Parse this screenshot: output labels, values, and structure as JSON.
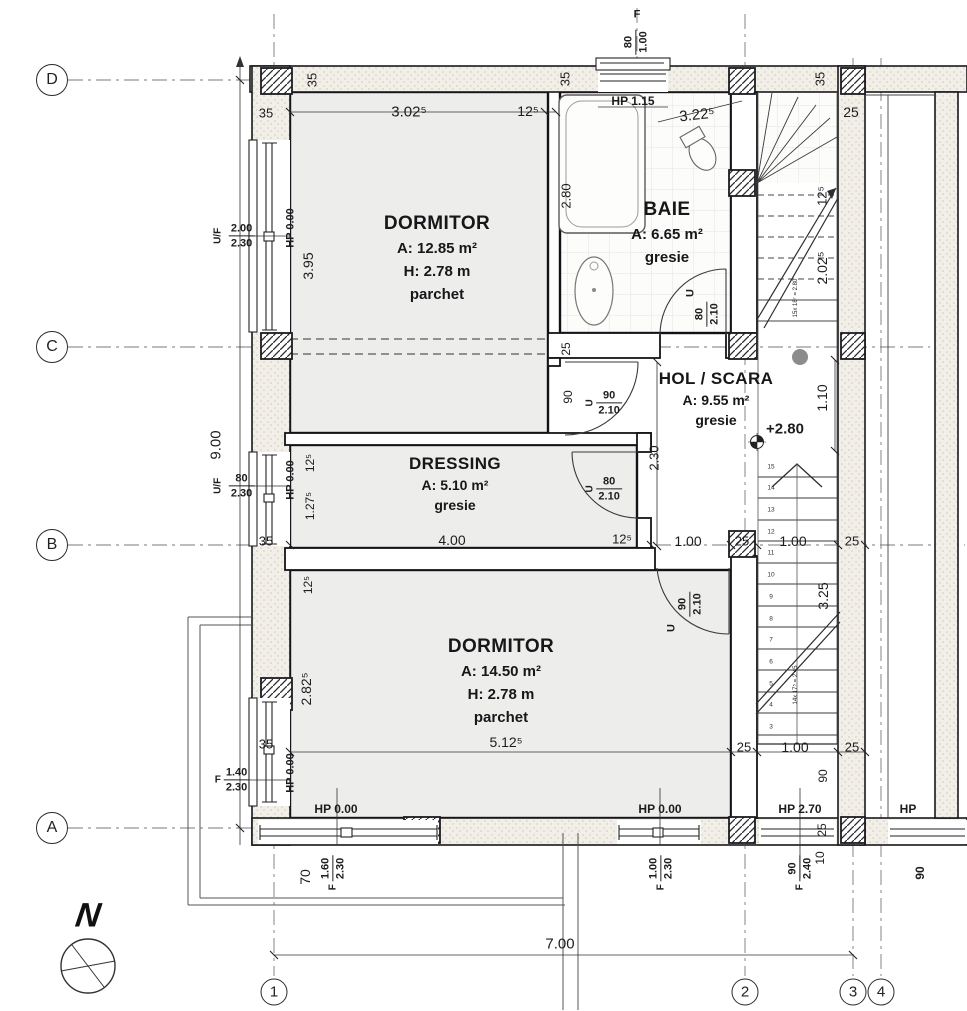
{
  "plan": {
    "type": "architectural-floor-plan",
    "north_label": "N",
    "overall": {
      "width": "7.00",
      "height": "9.00"
    },
    "grid": {
      "rows": [
        {
          "label": "D",
          "y": 80
        },
        {
          "label": "C",
          "y": 347
        },
        {
          "label": "B",
          "y": 545
        },
        {
          "label": "A",
          "y": 828
        }
      ],
      "cols": [
        {
          "label": "1",
          "x": 274
        },
        {
          "label": "2",
          "x": 745
        },
        {
          "label": "3",
          "x": 853
        },
        {
          "label": "4",
          "x": 881
        }
      ]
    },
    "rooms": [
      {
        "name": "DORMITOR",
        "area": "A: 12.85 m²",
        "height": "H: 2.78 m",
        "floor": "parchet",
        "x": 437,
        "y": 214
      },
      {
        "name": "BAIE",
        "area": "A: 6.65 m²",
        "floor": "gresie",
        "x": 667,
        "y": 200
      },
      {
        "name": "HOL / SCARA",
        "area": "A: 9.55 m²",
        "floor": "gresie",
        "x": 716,
        "y": 370,
        "small": 1
      },
      {
        "name": "DRESSING",
        "area": "A: 5.10 m²",
        "floor": "gresie",
        "x": 455,
        "y": 455,
        "small": 1
      },
      {
        "name": "DORMITOR",
        "area": "A: 14.50 m²",
        "height": "H: 2.78 m",
        "floor": "parchet",
        "x": 501,
        "y": 637
      }
    ],
    "dim_labels": [
      {
        "t": "F",
        "x": 637,
        "y": 15,
        "s": 11,
        "b": 1
      },
      {
        "t": "HP 1.15",
        "x": 633,
        "y": 101,
        "s": 12,
        "b": 1
      },
      {
        "t": "3.02⁵",
        "x": 409,
        "y": 112,
        "s": 15
      },
      {
        "t": "12⁵",
        "x": 528,
        "y": 111,
        "s": 14
      },
      {
        "t": "3.22⁵",
        "x": 697,
        "y": 115,
        "s": 15,
        "r": -6
      },
      {
        "t": "35",
        "x": 312,
        "y": 80,
        "s": 13,
        "r": -90
      },
      {
        "t": "35",
        "x": 565,
        "y": 79,
        "s": 13,
        "r": -90
      },
      {
        "t": "35",
        "x": 820,
        "y": 79,
        "s": 13,
        "r": -90
      },
      {
        "t": "35",
        "x": 266,
        "y": 113,
        "s": 13
      },
      {
        "t": "25",
        "x": 851,
        "y": 112,
        "s": 14
      },
      {
        "t": "HP 0.00",
        "x": 291,
        "y": 228,
        "s": 11,
        "b": 1,
        "r": -90
      },
      {
        "t": "3.95",
        "x": 308,
        "y": 266,
        "s": 14,
        "r": -90
      },
      {
        "t": "2.80",
        "x": 566,
        "y": 196,
        "s": 13,
        "r": -90
      },
      {
        "t": "9.00",
        "x": 216,
        "y": 445,
        "s": 15,
        "r": -90
      },
      {
        "t": "25",
        "x": 566,
        "y": 349,
        "s": 12,
        "r": -90
      },
      {
        "t": "90",
        "x": 568,
        "y": 397,
        "s": 12,
        "r": -90
      },
      {
        "t": "2.30",
        "x": 654,
        "y": 458,
        "s": 13,
        "r": -90
      },
      {
        "t": "1.10",
        "x": 822,
        "y": 398,
        "s": 14,
        "r": -90
      },
      {
        "t": "12⁵",
        "x": 822,
        "y": 196,
        "s": 13,
        "r": -90
      },
      {
        "t": "2.02⁵",
        "x": 822,
        "y": 268,
        "s": 14,
        "r": -90
      },
      {
        "t": "15x 18⁷ = 2.80",
        "x": 796,
        "y": 298,
        "s": 6,
        "r": -90
      },
      {
        "t": "+2.80",
        "x": 785,
        "y": 429,
        "s": 15,
        "b": 1
      },
      {
        "t": "U",
        "x": 691,
        "y": 293,
        "s": 11,
        "b": 1,
        "r": -90
      },
      {
        "t": "U",
        "x": 672,
        "y": 628,
        "s": 11,
        "b": 1,
        "r": -90
      },
      {
        "t": "HP 0.00",
        "x": 291,
        "y": 480,
        "s": 11,
        "b": 1,
        "r": -90
      },
      {
        "t": "12⁵",
        "x": 310,
        "y": 463,
        "s": 12,
        "r": -90
      },
      {
        "t": "1.27⁵",
        "x": 310,
        "y": 506,
        "s": 12,
        "r": -90
      },
      {
        "t": "35",
        "x": 266,
        "y": 541,
        "s": 13
      },
      {
        "t": "4.00",
        "x": 452,
        "y": 540,
        "s": 14
      },
      {
        "t": "12⁵",
        "x": 622,
        "y": 539,
        "s": 13
      },
      {
        "t": "1.00",
        "x": 688,
        "y": 541,
        "s": 14
      },
      {
        "t": "25",
        "x": 742,
        "y": 541,
        "s": 13
      },
      {
        "t": "1.00",
        "x": 793,
        "y": 541,
        "s": 14
      },
      {
        "t": "25",
        "x": 852,
        "y": 541,
        "s": 13
      },
      {
        "t": "12⁵",
        "x": 308,
        "y": 585,
        "s": 12,
        "r": -90
      },
      {
        "t": "2.82⁵",
        "x": 306,
        "y": 689,
        "s": 14,
        "r": -90
      },
      {
        "t": "3.25",
        "x": 823,
        "y": 596,
        "s": 14,
        "r": -90
      },
      {
        "t": "14x 17⁵ = 2.45",
        "x": 796,
        "y": 685,
        "s": 6,
        "r": -90
      },
      {
        "t": "HP 0.00",
        "x": 291,
        "y": 773,
        "s": 11,
        "b": 1,
        "r": -90
      },
      {
        "t": "35",
        "x": 266,
        "y": 744,
        "s": 13
      },
      {
        "t": "5.12⁵",
        "x": 506,
        "y": 742,
        "s": 14
      },
      {
        "t": "25",
        "x": 744,
        "y": 747,
        "s": 13
      },
      {
        "t": "1.00",
        "x": 795,
        "y": 747,
        "s": 14
      },
      {
        "t": "25",
        "x": 852,
        "y": 747,
        "s": 13
      },
      {
        "t": "HP 0.00",
        "x": 336,
        "y": 809,
        "s": 12,
        "b": 1
      },
      {
        "t": "HP 0.00",
        "x": 660,
        "y": 809,
        "s": 12,
        "b": 1
      },
      {
        "t": "HP 2.70",
        "x": 800,
        "y": 809,
        "s": 12,
        "b": 1
      },
      {
        "t": "HP",
        "x": 908,
        "y": 809,
        "s": 12,
        "b": 1
      },
      {
        "t": "70",
        "x": 305,
        "y": 877,
        "s": 14,
        "r": -90
      },
      {
        "t": "90",
        "x": 823,
        "y": 776,
        "s": 12,
        "r": -90
      },
      {
        "t": "25",
        "x": 822,
        "y": 830,
        "s": 12,
        "r": -90
      },
      {
        "t": "10",
        "x": 820,
        "y": 858,
        "s": 12,
        "r": -90
      },
      {
        "t": "90",
        "x": 920,
        "y": 873,
        "s": 12,
        "b": 1,
        "r": -90
      },
      {
        "t": "7.00",
        "x": 560,
        "y": 944,
        "s": 15
      }
    ],
    "frac_labels": [
      {
        "x": 232,
        "y": 236,
        "prefix": "U/F",
        "pr": 1,
        "top": "2.00",
        "bottom": "2.30"
      },
      {
        "x": 232,
        "y": 486,
        "prefix": "U/F",
        "pr": 1,
        "top": "80",
        "bottom": "2.30"
      },
      {
        "x": 232,
        "y": 780,
        "prefix": "F",
        "pr": 0,
        "top": "1.40",
        "bottom": "2.30"
      },
      {
        "x": 636,
        "y": 42,
        "prefix": "",
        "top": "80",
        "bottom": "1.00",
        "rot": -90
      },
      {
        "x": 604,
        "y": 403,
        "prefix": "U",
        "pr": 1,
        "top": "90",
        "bottom": "2.10"
      },
      {
        "x": 604,
        "y": 489,
        "prefix": "U",
        "pr": 1,
        "top": "80",
        "bottom": "2.10"
      },
      {
        "x": 707,
        "y": 314,
        "prefix": "",
        "top": "80",
        "bottom": "2.10",
        "rot": -90
      },
      {
        "x": 690,
        "y": 604,
        "prefix": "",
        "top": "90",
        "bottom": "2.10",
        "rot": -90
      },
      {
        "x": 333,
        "y": 873,
        "prefix": "F",
        "pr": 0,
        "top": "1.60",
        "bottom": "2.30",
        "rot": -90
      },
      {
        "x": 661,
        "y": 873,
        "prefix": "F",
        "pr": 0,
        "top": "1.00",
        "bottom": "2.30",
        "rot": -90
      },
      {
        "x": 800,
        "y": 873,
        "prefix": "F",
        "pr": 0,
        "top": "90",
        "bottom": "2.40",
        "rot": -90
      }
    ],
    "stair": {
      "numbers": [
        "3",
        "4",
        "5",
        "6",
        "7",
        "8",
        "9",
        "10",
        "11",
        "12",
        "13",
        "14",
        "15"
      ],
      "x": 771,
      "y_start": 727,
      "dy": 21.7
    }
  }
}
